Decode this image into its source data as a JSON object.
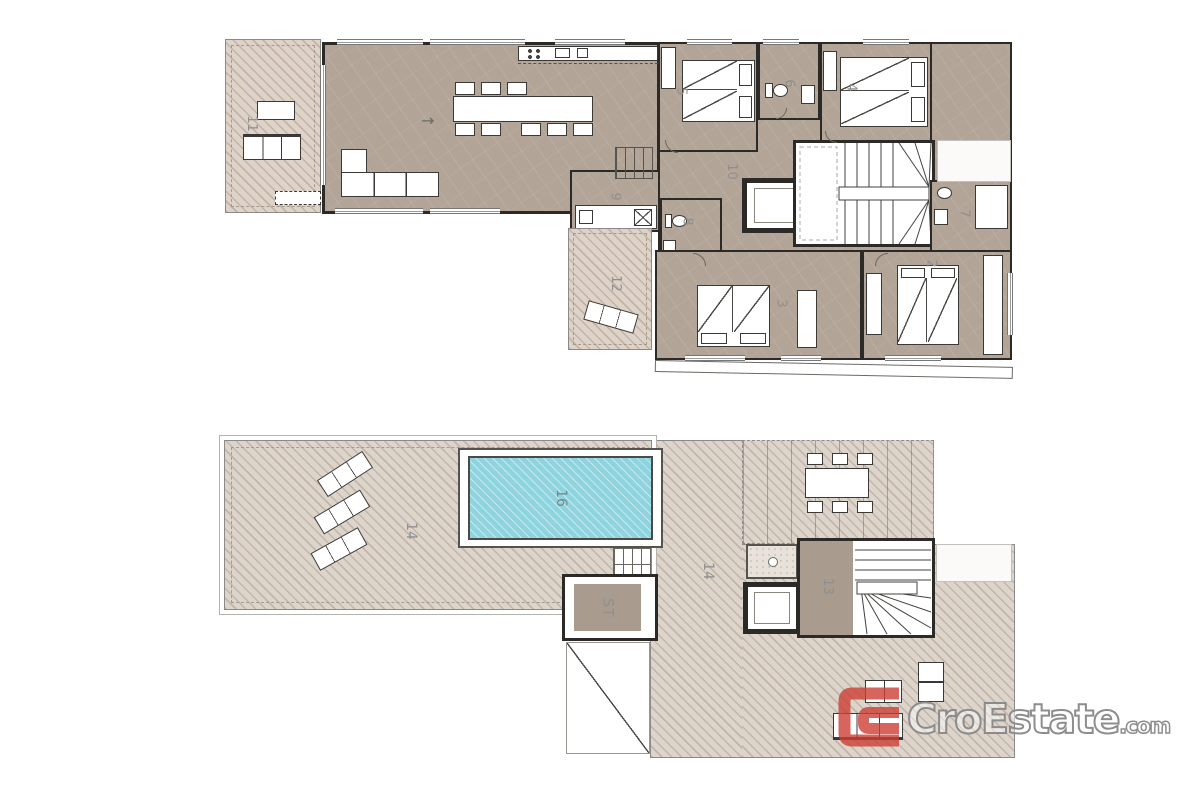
{
  "watermark": {
    "brand": "CroEstate",
    "tld": ".com",
    "logo_red": "#cd3f34"
  },
  "icons": {
    "entry_arrow": "→"
  },
  "colors": {
    "room_fill": "#b2a496",
    "terrace_fill": "#ded3c9",
    "roof_terrace_fill": "#ddd5cc",
    "pool_water": "#8ed3de",
    "wall": "#2b2a27",
    "label_gray": "#8f8f8f"
  },
  "plans": {
    "upper": {
      "name": "upper-floor-plan",
      "labels": {
        "terrace_left": "11",
        "bedroom_5": "5",
        "bath_6": "6",
        "bedroom_4": "4",
        "hallway": "10",
        "utility_9": "9",
        "wc_8": "8",
        "bath_7": "7",
        "bedroom_3": "3",
        "bedroom_2": "2",
        "terrace_12": "12"
      }
    },
    "roof": {
      "name": "roof-terrace-plan",
      "labels": {
        "terrace_main": "14",
        "pool": "16",
        "terrace_right": "14",
        "stairs_13": "13",
        "storage": "ST"
      }
    }
  }
}
